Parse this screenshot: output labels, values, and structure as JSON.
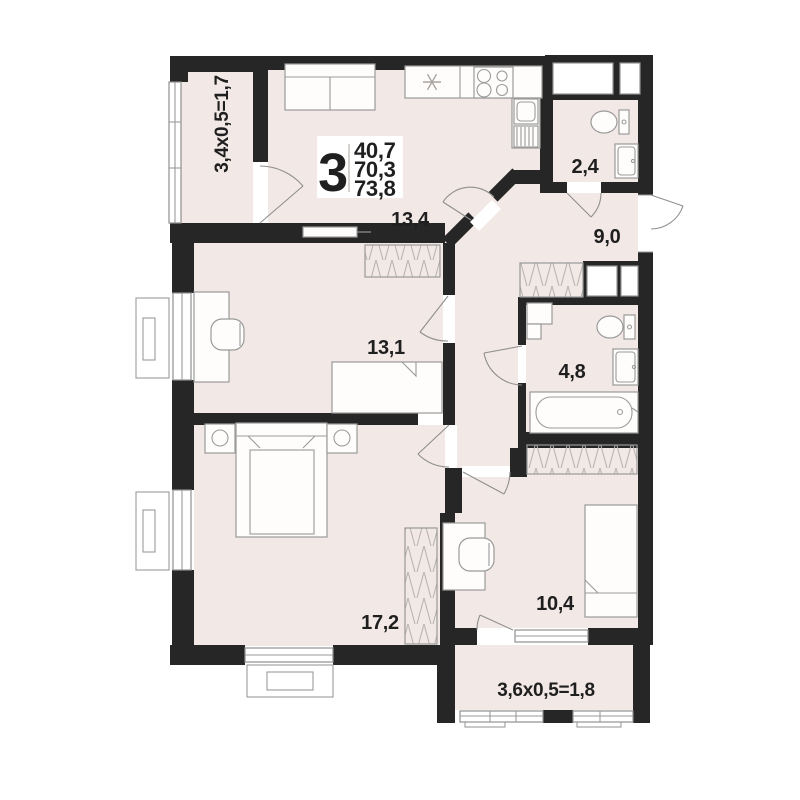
{
  "colors": {
    "wall": "#262626",
    "floor": "#f2e8e5",
    "line": "#9a9a9a",
    "label": "#1f1f1f"
  },
  "title_block": {
    "rooms_count": "3",
    "living_area": "40,7",
    "apartment_area": "70,3",
    "total_area": "73,8"
  },
  "rooms": {
    "kitchen_living": {
      "area": "13,4"
    },
    "toilet": {
      "area": "2,4"
    },
    "hallway": {
      "area": "9,0"
    },
    "bathroom": {
      "area": "4,8"
    },
    "bedroom_1": {
      "area": "13,1"
    },
    "bedroom_2": {
      "area": "17,2"
    },
    "bedroom_3": {
      "area": "10,4"
    },
    "balcony": {
      "dimensions": "3,4x0,5=1,7"
    },
    "loggia": {
      "dimensions": "3,6x0,5=1,8"
    }
  }
}
